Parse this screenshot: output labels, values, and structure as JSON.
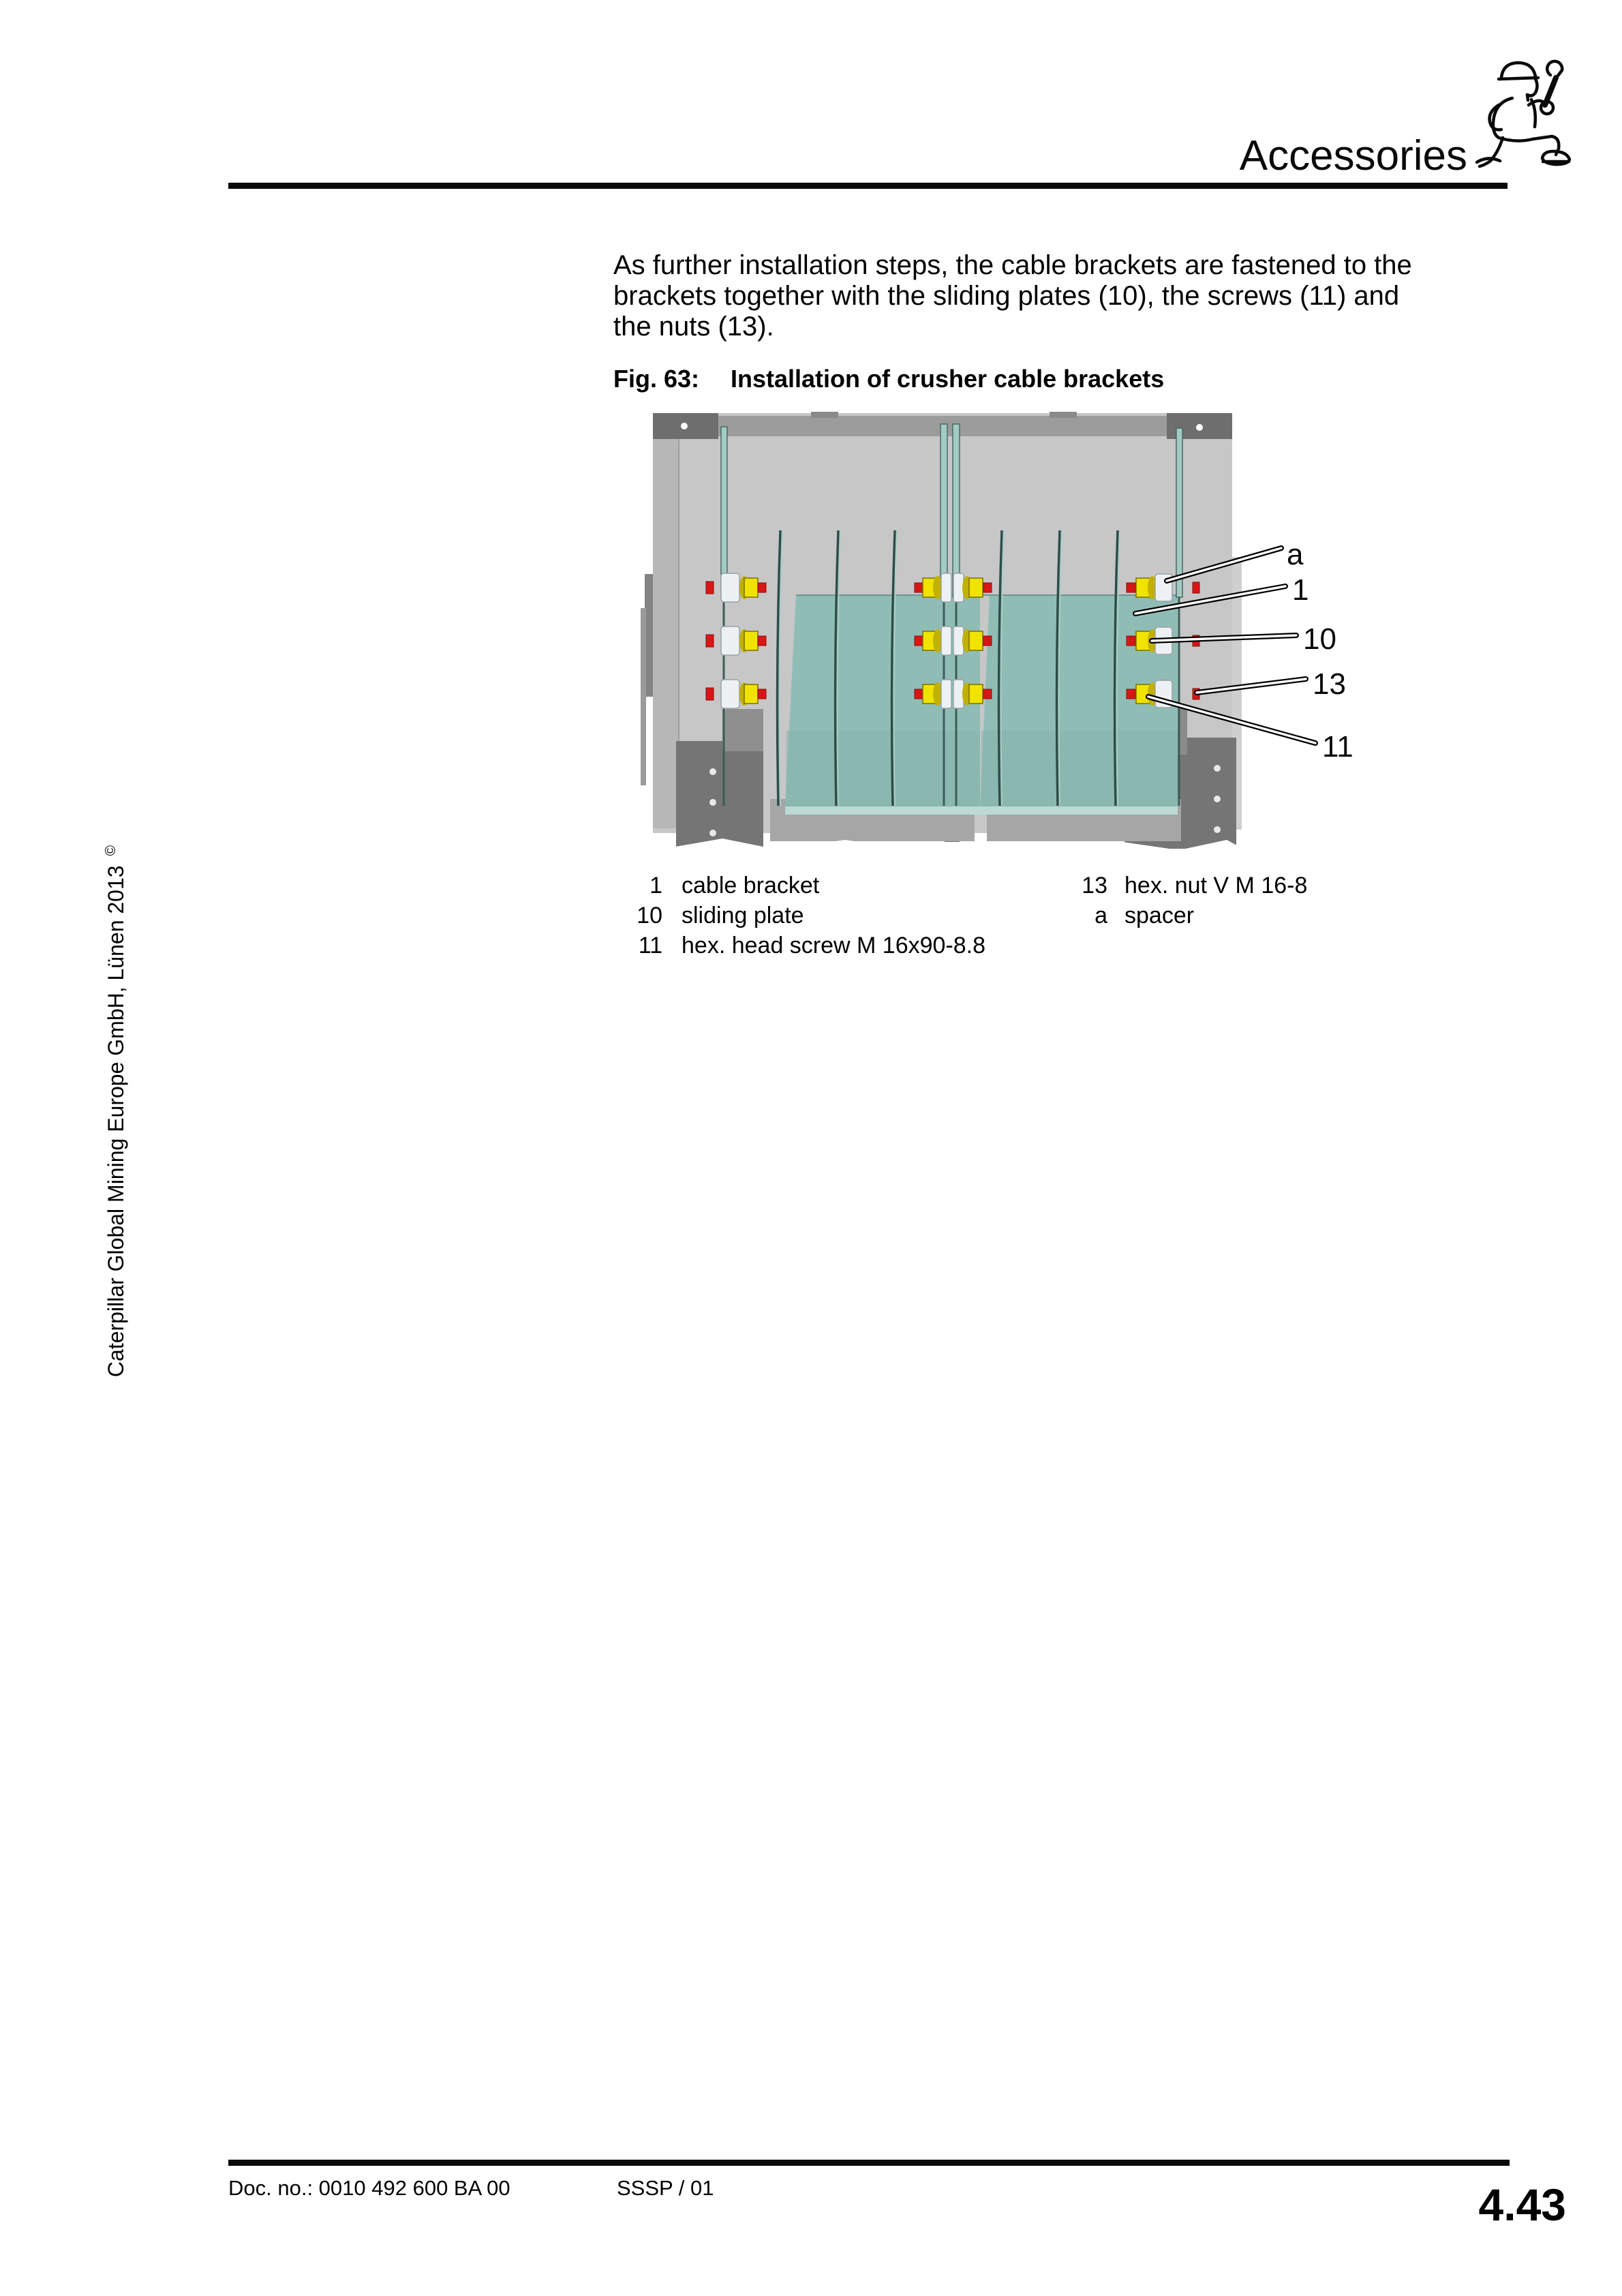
{
  "header": {
    "title": "Accessories",
    "icon": "kneeling-worker-with-wrench"
  },
  "intro": {
    "lines": [
      "As further installation steps, the cable brackets are fastened to the",
      "brackets together with the sliding plates (10), the screws (11) and",
      "the nuts (13)."
    ]
  },
  "figure": {
    "caption_label": "Fig. 63:",
    "caption_text": "Installation of crusher cable brackets",
    "callouts": [
      {
        "id": "a"
      },
      {
        "id": "1"
      },
      {
        "id": "10"
      },
      {
        "id": "13"
      },
      {
        "id": "11"
      }
    ],
    "colors": {
      "plate_teal": "#8fbdb5",
      "blade_teal": "#a3cac3",
      "panel_gray": "#c7c7c7",
      "dark_gray": "#757575",
      "fastener_yellow": "#f0e300",
      "fastener_red": "#d81616",
      "spacer_white": "#edf1f3"
    }
  },
  "legend": {
    "left": [
      {
        "num": "1",
        "label": "cable bracket"
      },
      {
        "num": "10",
        "label": "sliding plate"
      },
      {
        "num": "11",
        "label": "hex. head screw M 16x90-8.8"
      }
    ],
    "right": [
      {
        "num": "13",
        "label": "hex. nut V M 16-8"
      },
      {
        "num": "a",
        "label": "spacer"
      }
    ]
  },
  "sidebar": {
    "text": "Caterpillar Global Mining Europe GmbH, Lünen 2013",
    "symbol": "©"
  },
  "footer": {
    "doc_no": "Doc. no.: 0010 492 600 BA 00",
    "code": "SSSP / 01",
    "page_number": "4.43"
  }
}
